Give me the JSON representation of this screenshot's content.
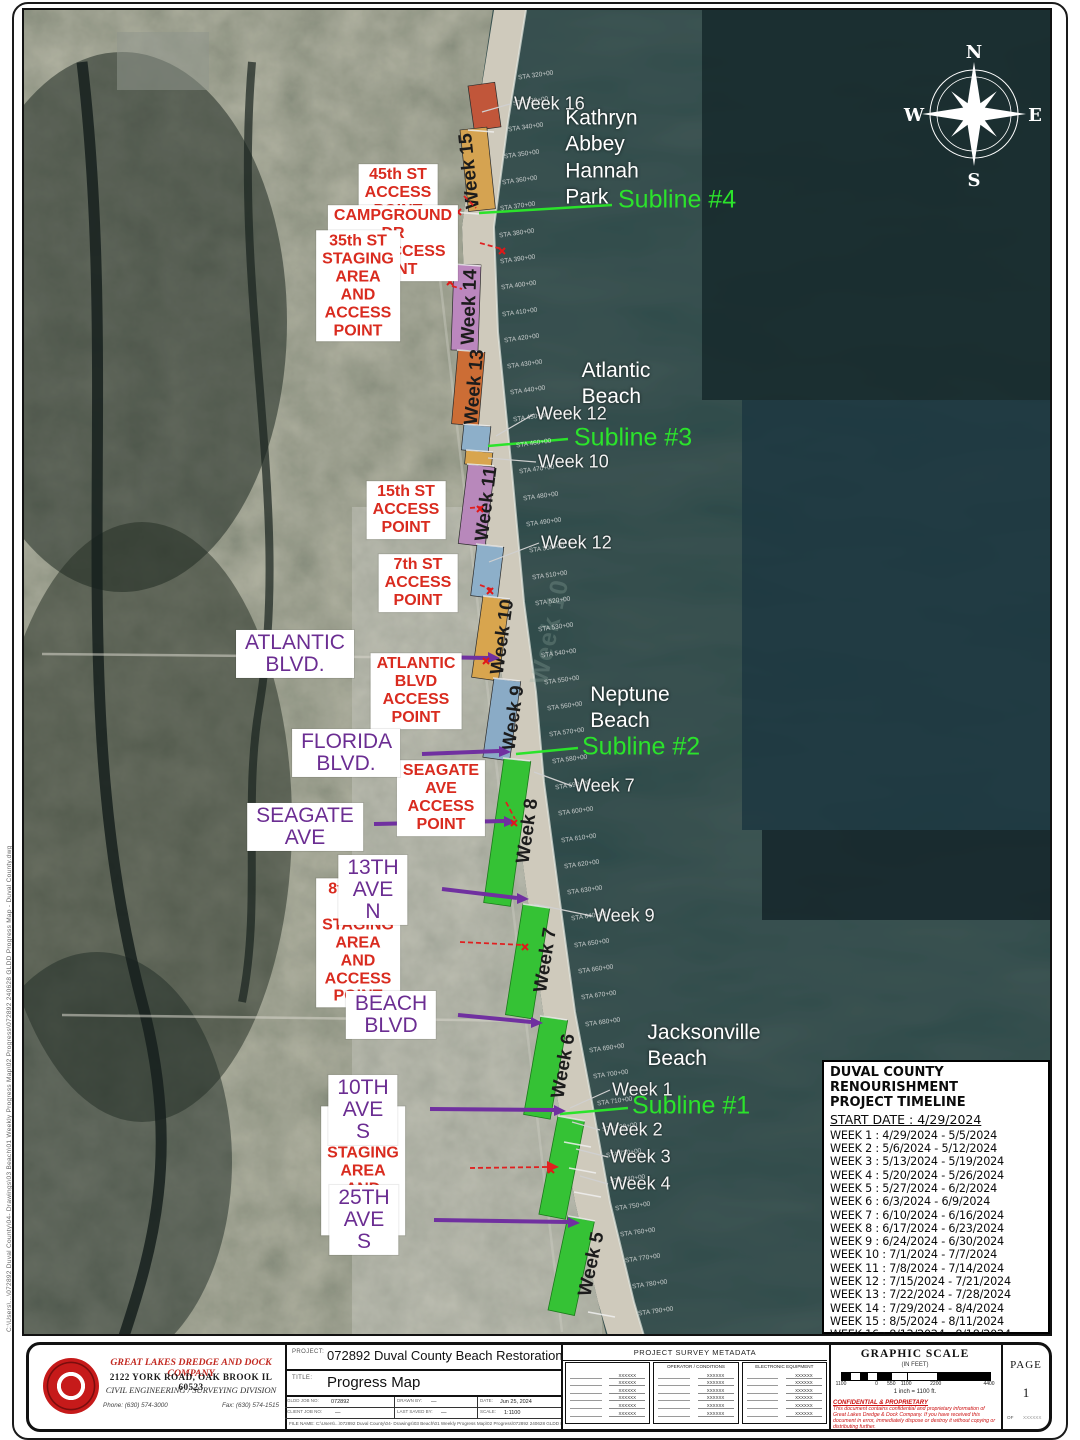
{
  "page": {
    "filepath": "C:\\Users\\...\\072892 Duval County\\04- Drawings\\03 Beach\\01 Weekly Progress Map\\02 Progress\\072892 240628 GLDD Progress Map - Duval County.dwg"
  },
  "map": {
    "compass": {
      "n": "N",
      "e": "E",
      "s": "S",
      "w": "W"
    },
    "watermark": "Week 10",
    "colors": {
      "week16": "#c1563a",
      "week15": "#d5a351",
      "week14": "#bb87be",
      "week13": "#cc6d35",
      "week12": "#8dafc9",
      "week11": "#b888bb",
      "week10": "#d8a54e",
      "week9": "#8aabc6",
      "green": "#35c235",
      "subline": "#2be32b",
      "street": "#7030a0",
      "access_red": "#e02020"
    },
    "segments": [
      {
        "name": "week-16",
        "color": "#c1563a"
      },
      {
        "name": "week-15",
        "color": "#d5a351",
        "label": "Week 15"
      },
      {
        "name": "week-14",
        "color": "#bb87be",
        "label": "Week 14"
      },
      {
        "name": "week-13",
        "color": "#cc6d35",
        "label": "Week 13"
      },
      {
        "name": "week-12-north",
        "color": "#8dafc9"
      },
      {
        "name": "week-10-chip",
        "color": "#d8a54e"
      },
      {
        "name": "week-11",
        "color": "#b888bb",
        "label": "Week 11"
      },
      {
        "name": "week-12-south",
        "color": "#8dafc9"
      },
      {
        "name": "week-10",
        "color": "#d8a54e",
        "label": "Week 10"
      },
      {
        "name": "week-9",
        "color": "#8aabc6",
        "label": "Week 9"
      },
      {
        "name": "week-8",
        "color": "#35c235",
        "label": "Week 8"
      },
      {
        "name": "week-7",
        "color": "#35c235",
        "label": "Week 7"
      },
      {
        "name": "week-6",
        "color": "#35c235",
        "label": "Week 6"
      },
      {
        "name": "weeks-1-4",
        "color": "#35c235"
      },
      {
        "name": "week-5",
        "color": "#35c235",
        "label": "Week 5"
      }
    ],
    "city_labels": [
      {
        "t": "Kathryn Abbey\nHannah Park",
        "x": 600,
        "y": 156
      },
      {
        "t": "Atlantic Beach",
        "x": 614,
        "y": 382
      },
      {
        "t": "Neptune Beach",
        "x": 628,
        "y": 706
      },
      {
        "t": "Jacksonville Beach",
        "x": 702,
        "y": 1044
      }
    ],
    "red_labels": [
      {
        "t": "45th ST\nACCESS POINT",
        "x": 396,
        "y": 191
      },
      {
        "t": "CAMPGROUND DR\nAND ACCESS POINT",
        "x": 391,
        "y": 241
      },
      {
        "t": "35th ST STAGING AREA\nAND ACCESS POINT",
        "x": 356,
        "y": 284
      },
      {
        "t": "15th ST\nACCESS POINT",
        "x": 404,
        "y": 508
      },
      {
        "t": "7th ST\nACCESS POINT",
        "x": 416,
        "y": 581
      },
      {
        "t": "ATLANTIC BLVD\nACCESS POINT",
        "x": 414,
        "y": 689
      },
      {
        "t": "SEAGATE AVE\nACCESS POINT",
        "x": 439,
        "y": 796
      },
      {
        "t": "8th AVE N STAGING AREA\nAND ACCESS POINT",
        "x": 356,
        "y": 941
      },
      {
        "t": "16th AVE S STAGING AREA\nAND ACCESS POINT",
        "x": 361,
        "y": 1169
      }
    ],
    "purple_labels": [
      {
        "t": "ATLANTIC BLVD.",
        "x": 293,
        "y": 652
      },
      {
        "t": "FLORIDA BLVD.",
        "x": 344,
        "y": 751
      },
      {
        "t": "SEAGATE AVE",
        "x": 303,
        "y": 825
      },
      {
        "t": "13TH AVE N",
        "x": 371,
        "y": 888
      },
      {
        "t": "BEACH BLVD",
        "x": 389,
        "y": 1013
      },
      {
        "t": "10TH AVE S",
        "x": 361,
        "y": 1108
      },
      {
        "t": "25TH AVE S",
        "x": 362,
        "y": 1218
      }
    ],
    "green_labels": [
      {
        "t": "Subline #4",
        "x": 616,
        "y": 198
      },
      {
        "t": "Subline #3",
        "x": 572,
        "y": 436
      },
      {
        "t": "Subline #2",
        "x": 580,
        "y": 745
      },
      {
        "t": "Subline #1",
        "x": 630,
        "y": 1104
      }
    ],
    "week_callouts": [
      {
        "t": "Week 16",
        "x": 512,
        "y": 102
      },
      {
        "t": "Week 12",
        "x": 534,
        "y": 412
      },
      {
        "t": "Week 10",
        "x": 536,
        "y": 460
      },
      {
        "t": "Week 12",
        "x": 539,
        "y": 541
      },
      {
        "t": "Week 7",
        "x": 572,
        "y": 784
      },
      {
        "t": "Week 9",
        "x": 592,
        "y": 914
      },
      {
        "t": "Week 1",
        "x": 610,
        "y": 1088
      },
      {
        "t": "Week 2",
        "x": 600,
        "y": 1128
      },
      {
        "t": "Week 3",
        "x": 608,
        "y": 1155
      },
      {
        "t": "Week 4",
        "x": 608,
        "y": 1182
      }
    ],
    "stations": [
      {
        "t": "STA 320+00",
        "x": 516,
        "y": 70
      },
      {
        "t": "STA 330+00",
        "x": 511,
        "y": 96
      },
      {
        "t": "STA 340+00",
        "x": 506,
        "y": 122
      },
      {
        "t": "STA 350+00",
        "x": 502,
        "y": 149
      },
      {
        "t": "STA 360+00",
        "x": 500,
        "y": 175
      },
      {
        "t": "STA 370+00",
        "x": 498,
        "y": 201
      },
      {
        "t": "STA 380+00",
        "x": 497,
        "y": 228
      },
      {
        "t": "STA 390+00",
        "x": 498,
        "y": 254
      },
      {
        "t": "STA 400+00",
        "x": 499,
        "y": 280
      },
      {
        "t": "STA 410+00",
        "x": 500,
        "y": 307
      },
      {
        "t": "STA 420+00",
        "x": 502,
        "y": 333
      },
      {
        "t": "STA 430+00",
        "x": 505,
        "y": 359
      },
      {
        "t": "STA 440+00",
        "x": 508,
        "y": 385
      },
      {
        "t": "STA 450+00",
        "x": 511,
        "y": 412
      },
      {
        "t": "STA 460+00",
        "x": 514,
        "y": 438
      },
      {
        "t": "STA 470+00",
        "x": 517,
        "y": 464
      },
      {
        "t": "STA 480+00",
        "x": 521,
        "y": 491
      },
      {
        "t": "STA 490+00",
        "x": 524,
        "y": 517
      },
      {
        "t": "STA 500+00",
        "x": 527,
        "y": 543
      },
      {
        "t": "STA 510+00",
        "x": 530,
        "y": 570
      },
      {
        "t": "STA 520+00",
        "x": 533,
        "y": 596
      },
      {
        "t": "STA 530+00",
        "x": 536,
        "y": 622
      },
      {
        "t": "STA 540+00",
        "x": 539,
        "y": 648
      },
      {
        "t": "STA 550+00",
        "x": 542,
        "y": 675
      },
      {
        "t": "STA 560+00",
        "x": 545,
        "y": 701
      },
      {
        "t": "STA 570+00",
        "x": 547,
        "y": 727
      },
      {
        "t": "STA 580+00",
        "x": 550,
        "y": 754
      },
      {
        "t": "STA 590+00",
        "x": 553,
        "y": 780
      },
      {
        "t": "STA 600+00",
        "x": 556,
        "y": 806
      },
      {
        "t": "STA 610+00",
        "x": 559,
        "y": 833
      },
      {
        "t": "STA 620+00",
        "x": 562,
        "y": 859
      },
      {
        "t": "STA 630+00",
        "x": 565,
        "y": 885
      },
      {
        "t": "STA 640+00",
        "x": 569,
        "y": 911
      },
      {
        "t": "STA 650+00",
        "x": 572,
        "y": 938
      },
      {
        "t": "STA 660+00",
        "x": 576,
        "y": 964
      },
      {
        "t": "STA 670+00",
        "x": 579,
        "y": 990
      },
      {
        "t": "STA 680+00",
        "x": 583,
        "y": 1017
      },
      {
        "t": "STA 690+00",
        "x": 587,
        "y": 1043
      },
      {
        "t": "STA 700+00",
        "x": 591,
        "y": 1069
      },
      {
        "t": "STA 710+00",
        "x": 595,
        "y": 1096
      },
      {
        "t": "STA 720+00",
        "x": 600,
        "y": 1122
      },
      {
        "t": "STA 730+00",
        "x": 604,
        "y": 1148
      },
      {
        "t": "STA 740+00",
        "x": 608,
        "y": 1174
      },
      {
        "t": "STA 750+00",
        "x": 613,
        "y": 1201
      },
      {
        "t": "STA 760+00",
        "x": 618,
        "y": 1227
      },
      {
        "t": "STA 770+00",
        "x": 623,
        "y": 1253
      },
      {
        "t": "STA 780+00",
        "x": 630,
        "y": 1279
      },
      {
        "t": "STA 790+00",
        "x": 636,
        "y": 1306
      }
    ]
  },
  "timeline": {
    "title": "DUVAL COUNTY RENOURISHMENT\nPROJECT TIMELINE",
    "start": "START DATE : 4/29/2024",
    "weeks": [
      {
        "t": "WEEK 1 : 4/29/2024 - 5/5/2024"
      },
      {
        "t": "WEEK 2 : 5/6/2024 - 5/12/2024"
      },
      {
        "t": "WEEK 3 : 5/13/2024 - 5/19/2024"
      },
      {
        "t": "WEEK 4 : 5/20/2024 - 5/26/2024"
      },
      {
        "t": "WEEK 5 : 5/27/2024 - 6/2/2024"
      },
      {
        "t": "WEEK 6 : 6/3/2024 - 6/9/2024"
      },
      {
        "t": "WEEK 7 : 6/10/2024 - 6/16/2024"
      },
      {
        "t": "WEEK 8 : 6/17/2024 - 6/23/2024"
      },
      {
        "t": "WEEK 9 :  6/24/2024 - 6/30/2024"
      },
      {
        "t": "WEEK 10 : 7/1/2024 - 7/7/2024"
      },
      {
        "t": "WEEK 11 : 7/8/2024 - 7/14/2024"
      },
      {
        "t": "WEEK 12 : 7/15/2024 - 7/21/2024"
      },
      {
        "t": "WEEK 13 : 7/22/2024 - 7/28/2024"
      },
      {
        "t": "WEEK 14 : 7/29/2024 - 8/4/2024"
      },
      {
        "t": "WEEK 15 : 8/5/2024 - 8/11/2024"
      },
      {
        "t": "WEEK 16 : 8/12/2024 - 8/18/2024"
      }
    ]
  },
  "titleblock": {
    "company": {
      "name": "GREAT LAKES DREDGE AND DOCK COMPANY",
      "address": "2122 YORK ROAD, OAK BROOK IL 60523",
      "division": "CIVIL ENGINEERING / SURVEYING DIVISION",
      "phone": "Phone: (630) 574-3000",
      "fax": "Fax: (630) 574-1515"
    },
    "project_label": "PROJECT:",
    "project": "072892 Duval County Beach Restoration",
    "title_label": "TITLE:",
    "title": "Progress Map",
    "fields": [
      {
        "l": "GLDD JOB NO:",
        "v": "072892"
      },
      {
        "l": "DRAWN BY:",
        "v": "—"
      },
      {
        "l": "DATE:",
        "v": "Jun 25, 2024"
      },
      {
        "l": "CLIENT JOB NO:",
        "v": "—"
      },
      {
        "l": "LAST SAVED BY:",
        "v": "—"
      },
      {
        "l": "SCALE:",
        "v": "1:1100"
      }
    ],
    "filename_label": "FILE NAME:",
    "metadata_title": "PROJECT SURVEY METADATA",
    "meta_box2": "OPERATOR / CONDITIONS",
    "meta_box3": "ELECTRONIC EQUIPMENT",
    "meta_value": "XXXXXX",
    "scale": {
      "title": "GRAPHIC SCALE",
      "units": "(IN FEET)",
      "ticks": [
        "1100",
        "0",
        "550",
        "1100",
        "2200",
        "4400"
      ],
      "note": "1 inch = 1100 ft."
    },
    "confidential_title": "CONFIDENTIAL & PROPRIETARY",
    "confidential_body": "This document contains confidential and proprietary information of Great Lakes Dredge & Dock Company. If you have received this document in error, immediately dispose or destroy it without copying or distributing further.",
    "page_label": "PAGE",
    "page_number": "1",
    "of_label": "OF"
  }
}
